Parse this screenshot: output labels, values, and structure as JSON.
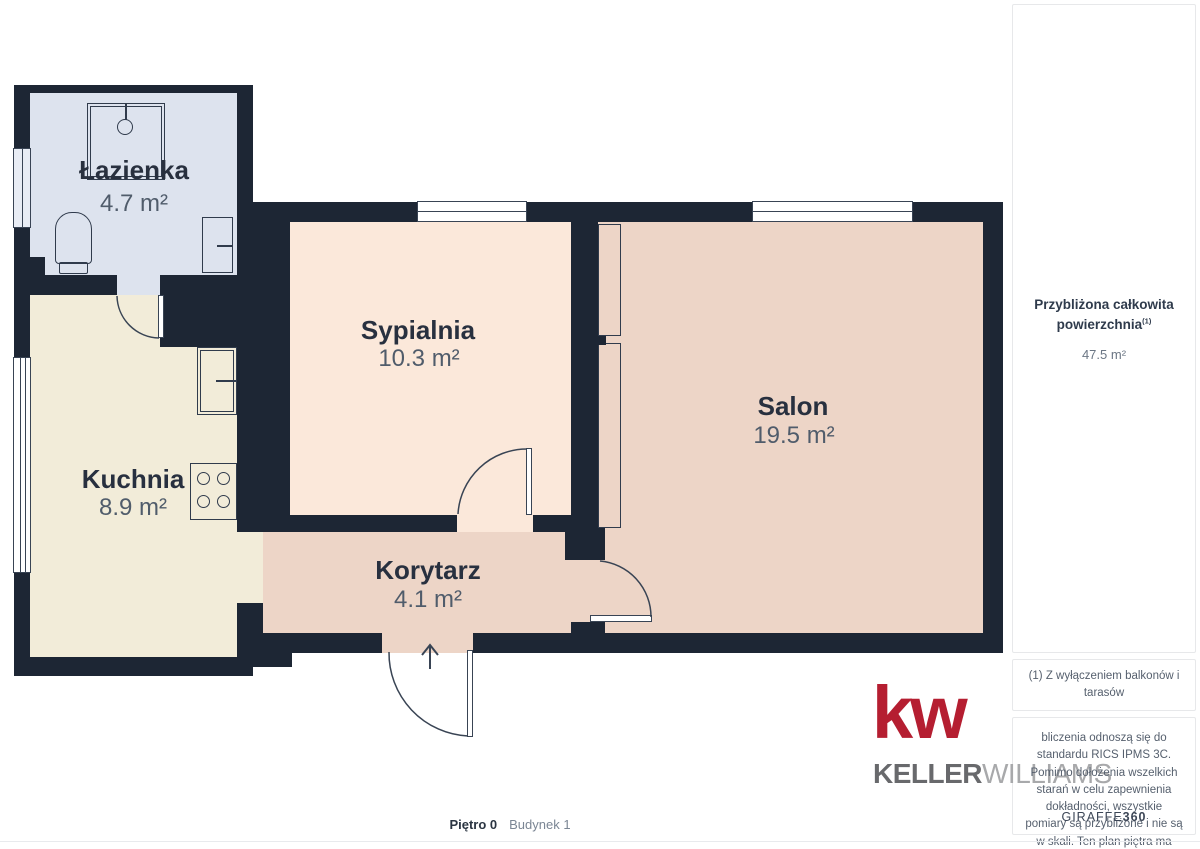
{
  "plan": {
    "rooms": [
      {
        "id": "lazienka",
        "name": "Łazienka",
        "area": "4.7 m²"
      },
      {
        "id": "kuchnia",
        "name": "Kuchnia",
        "area": "8.9 m²"
      },
      {
        "id": "sypialnia",
        "name": "Sypialnia",
        "area": "10.3 m²"
      },
      {
        "id": "korytarz",
        "name": "Korytarz",
        "area": "4.1 m²"
      },
      {
        "id": "salon",
        "name": "Salon",
        "area": "19.5 m²"
      }
    ],
    "colors": {
      "wall": "#1d2634",
      "bathroom_floor": "#dde3ee",
      "kitchen_floor": "#f2ecd9",
      "bedroom_floor": "#fbe8da",
      "living_floor": "#edd5c7",
      "outline": "#394454"
    }
  },
  "sidebar": {
    "total": {
      "label_line1": "Przybliżona całkowita",
      "label_line2": "powierzchnia",
      "superscript": "(1)",
      "value": "47.5 m²"
    },
    "footnote": "(1) Z wyłączeniem balkonów i tarasów",
    "disclaimer": "bliczenia odnoszą się do standardu RICS IPMS 3C. Pomimo dołożenia wszelkich starań w celu zapewnienia dokładności, wszystkie pomiary są przybliżone i nie są w skali. Ten plan piętra ma charakter poglądowy.",
    "brand": {
      "giraffe": "GIRAFFE",
      "n360": "360"
    }
  },
  "logo": {
    "kw": "kw",
    "keller": "KELLER",
    "williams": "WILLIAMS"
  },
  "footer": {
    "floor": "Piętro 0",
    "building": "Budynek 1"
  }
}
